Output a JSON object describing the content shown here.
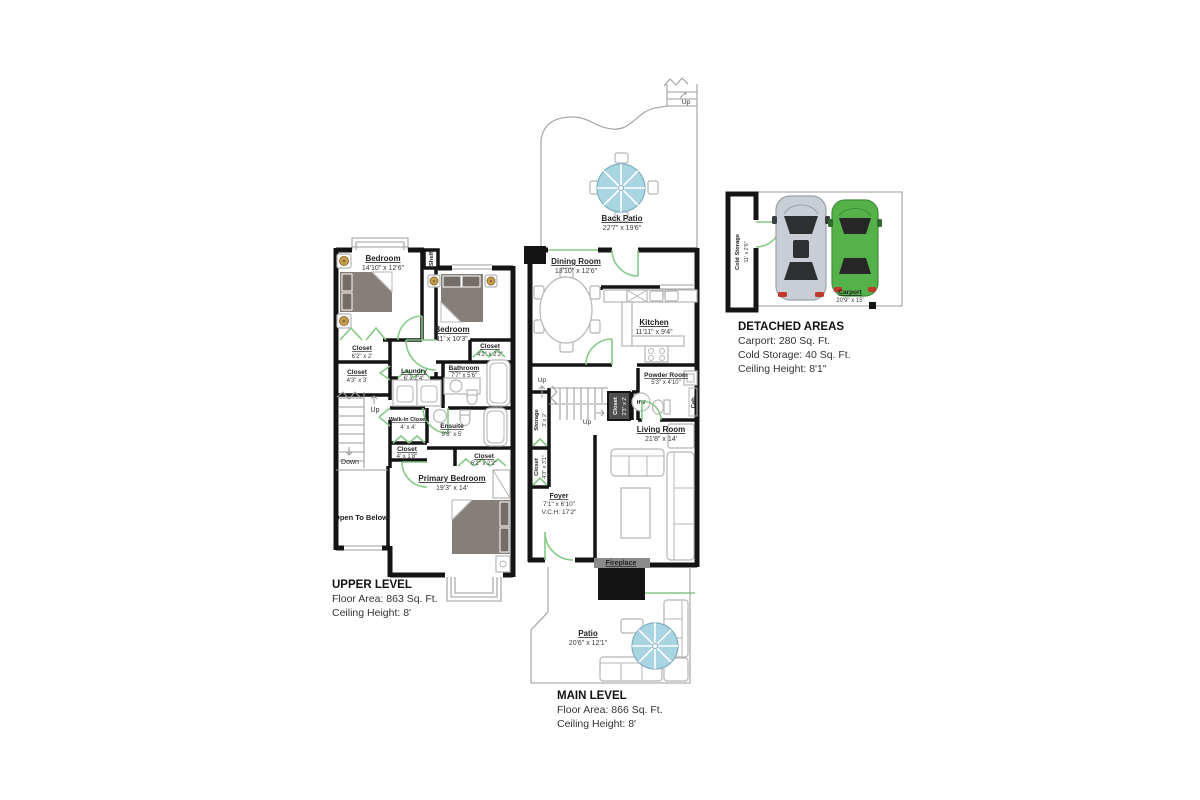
{
  "upper_level": {
    "title": "UPPER LEVEL",
    "area": "Floor Area: 863 Sq. Ft.",
    "ceiling": "Ceiling Height: 8'",
    "rooms": {
      "bedroom1": {
        "name": "Bedroom",
        "dim": "14'10\" x 12'6\""
      },
      "bedroom2": {
        "name": "Bedroom",
        "dim": "11' x 10'3\""
      },
      "closet1": {
        "name": "Closet",
        "dim": "6'2\" x 2'"
      },
      "closet2": {
        "name": "Closet",
        "dim": "4'2\" x 2'2\""
      },
      "closet3": {
        "name": "Closet",
        "dim": "4'3\" x 3'"
      },
      "laundry": {
        "name": "Laundry",
        "dim": "6' x 2'4\""
      },
      "bathroom": {
        "name": "Bathroom",
        "dim": "7'7\" x 5'6\""
      },
      "walkin": {
        "name": "Walk-In Closet",
        "dim": "4' x 4'"
      },
      "ensuite": {
        "name": "Ensuite",
        "dim": "9'8\" x 5'"
      },
      "closet4": {
        "name": "Closet",
        "dim": "4' x 1'8\""
      },
      "closet5": {
        "name": "Closet",
        "dim": "6'2\" x 2'2\""
      },
      "primary": {
        "name": "Primary Bedroom",
        "dim": "19'3\" x 14'"
      }
    },
    "labels": {
      "shelf": "Shelf",
      "open_to_below": "Open To Below",
      "up": "Up",
      "down": "Down"
    }
  },
  "main_level": {
    "title": "MAIN LEVEL",
    "area": "Floor Area: 866 Sq. Ft.",
    "ceiling": "Ceiling Height: 8'",
    "rooms": {
      "back_patio": {
        "name": "Back Patio",
        "dim": "22'7\" x 19'6\""
      },
      "dining": {
        "name": "Dining Room",
        "dim": "13'10\" x 12'6\""
      },
      "kitchen": {
        "name": "Kitchen",
        "dim": "11'11\" x 9'4\""
      },
      "powder": {
        "name": "Powder Room",
        "dim": "5'3\" x 4'10\""
      },
      "living": {
        "name": "Living Room",
        "dim": "21'8\" x 14'"
      },
      "storage": {
        "name": "Storage",
        "dim": "3' x 2'"
      },
      "closet_side": {
        "name": "Closet",
        "dim": "4'3\" x 3'1\""
      },
      "closet_stairs": {
        "name": "Closet",
        "dim": "2'3\" x 2'"
      },
      "foyer": {
        "name": "Foyer",
        "dim": "7'1\" x 6'10\"",
        "vch": "V.C.H: 17'2\""
      },
      "fireplace": {
        "name": "Fireplace"
      },
      "patio": {
        "name": "Patio",
        "dim": "20'6\" x 12'1\""
      }
    },
    "labels": {
      "up": "Up",
      "hw": "HW",
      "cab": "Cab."
    }
  },
  "detached": {
    "title": "DETACHED AREAS",
    "carport_line": "Carport: 280 Sq. Ft.",
    "cold_storage_line": "Cold Storage: 40 Sq. Ft.",
    "ceiling": "Ceiling Height: 8'1\"",
    "rooms": {
      "cold_storage": {
        "name": "Cold Storage",
        "dim": "11' x 2'6\""
      },
      "carport": {
        "name": "Carport",
        "dim": "20'9\" x 15'"
      }
    }
  },
  "colors": {
    "wall": "#141414",
    "door_green": "#86c986",
    "umbrella_blue": "#a9d4e1",
    "bed_taupe": "#867e79",
    "car_silver": "#c9ced6",
    "car_green": "#55b24b"
  }
}
